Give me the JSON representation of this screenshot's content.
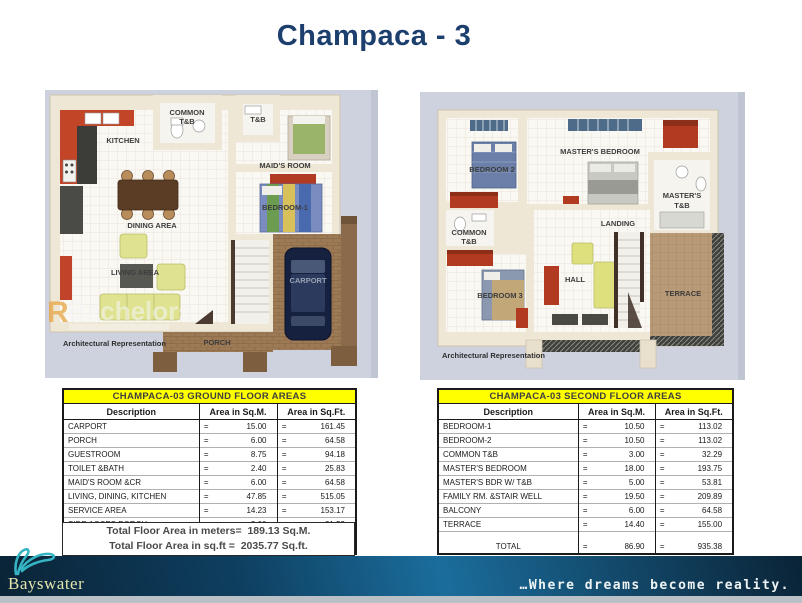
{
  "title": "Champaca - 3",
  "watermark": {
    "letter": "R",
    "word": "Bachelors"
  },
  "plans": {
    "ground": {
      "note": "Architectural Representation",
      "rooms": {
        "kitchen": "KITCHEN",
        "common_l1": "COMMON",
        "common_l2": "T&B",
        "tb": "T&B",
        "maids": "MAID'S ROOM",
        "bedroom1": "BEDROOM-1",
        "dining": "DINING AREA",
        "living": "LIVING AREA",
        "carport": "CARPORT",
        "porch": "PORCH"
      }
    },
    "second": {
      "note": "Architectural Representation",
      "rooms": {
        "bedroom2": "BEDROOM 2",
        "masters": "MASTER'S BEDROOM",
        "masters_tb_l1": "MASTER'S",
        "masters_tb_l2": "T&B",
        "common_l1": "COMMON",
        "common_l2": "T&B",
        "landing": "LANDING",
        "hall": "HALL",
        "bedroom3": "BEDROOM 3",
        "terrace": "TERRACE"
      }
    }
  },
  "tables": {
    "eq": "=",
    "ground": {
      "title": "CHAMPACA-03 GROUND FLOOR AREAS",
      "headers": [
        "Description",
        "Area in Sq.M.",
        "Area in Sq.Ft."
      ],
      "rows": [
        [
          "CARPORT",
          "15.00",
          "161.45"
        ],
        [
          "PORCH",
          "6.00",
          "64.58"
        ],
        [
          "GUESTROOM",
          "8.75",
          "94.18"
        ],
        [
          "TOILET &BATH",
          "2.40",
          "25.83"
        ],
        [
          "MAID'S ROOM &CR",
          "6.00",
          "64.58"
        ],
        [
          "LIVING, DINING, KITCHEN",
          "47.85",
          "515.05"
        ],
        [
          "SERVICE AREA",
          "14.23",
          "153.17"
        ],
        [
          "SIDE ACCES PORCH",
          "2.00",
          "21.53"
        ]
      ],
      "total": {
        "label": "TOTAL",
        "sqm": "102.23",
        "sqft": "1,100.39"
      }
    },
    "second": {
      "title": "CHAMPACA-03 SECOND FLOOR AREAS",
      "headers": [
        "Description",
        "Area in Sq.M.",
        "Area in Sq.Ft."
      ],
      "rows": [
        [
          "BEDROOM-1",
          "10.50",
          "113.02"
        ],
        [
          "BEDROOM-2",
          "10.50",
          "113.02"
        ],
        [
          "COMMON T&B",
          "3.00",
          "32.29"
        ],
        [
          "MASTER'S BEDROOM",
          "18.00",
          "193.75"
        ],
        [
          "MASTER'S BDR W/ T&B",
          "5.00",
          "53.81"
        ],
        [
          "FAMILY RM. &STAIR WELL",
          "19.50",
          "209.89"
        ],
        [
          "BALCONY",
          "6.00",
          "64.58"
        ],
        [
          "TERRACE",
          "14.40",
          "155.00"
        ]
      ],
      "total": {
        "label": "TOTAL",
        "sqm": "86.90",
        "sqft": "935.38"
      }
    }
  },
  "summary": {
    "line1_label": "Total Floor Area in meters=",
    "line1_value": "189.13 Sq.M.",
    "line2_label": "Total Floor Area in  sq.ft  =",
    "line2_value": "2035.77 Sq.ft."
  },
  "footer": {
    "brand": "Bayswater",
    "tagline": "…Where dreams become reality."
  },
  "colors": {
    "title_navy": "#1d3f6e",
    "table_header_yellow": "#ffff00",
    "footer_teal": "#1b6d9c",
    "logo_teal": "#35b4c3"
  }
}
